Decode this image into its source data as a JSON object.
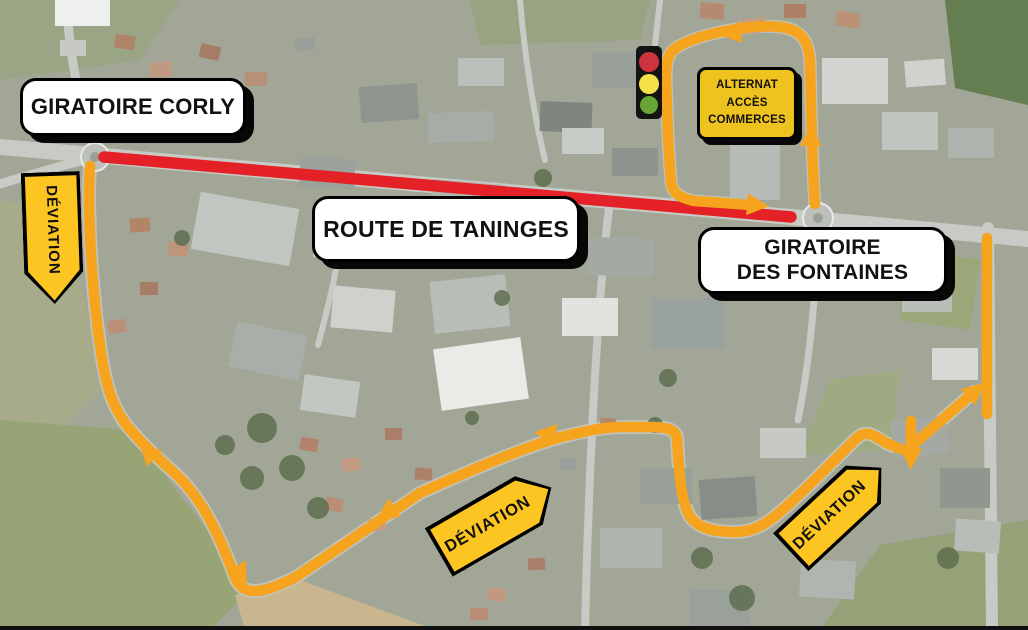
{
  "map_labels": {
    "giratoire_corly": "GIRATOIRE CORLY",
    "route_de_taninges": "ROUTE DE TANINGES",
    "giratoire_des_fontaines": {
      "line1": "GIRATOIRE",
      "line2": "DES FONTAINES"
    },
    "alternat_access": {
      "line1": "ALTERNAT",
      "line2": "ACCÈS",
      "line3": "COMMERCES"
    }
  },
  "deviation_signs": [
    {
      "text": "DÉVIATION",
      "placement": "west",
      "pointing": "down"
    },
    {
      "text": "DÉVIATION",
      "placement": "south-center",
      "pointing": "up-right"
    },
    {
      "text": "DÉVIATION",
      "placement": "south-east",
      "pointing": "up-right"
    }
  ],
  "icons": {
    "traffic_light": "traffic-light-icon"
  },
  "colors": {
    "closed_route_red": "#E32127",
    "deviation_route_orange": "#F6A41E",
    "deviation_sign_yellow": "#FCC521",
    "alternat_box_yellow": "#EFC31F",
    "label_background": "#FFFFFF",
    "label_text": "#111111",
    "traffic_light_red": "#CE3340",
    "traffic_light_yellow": "#F6E14B",
    "traffic_light_green": "#68A534"
  }
}
